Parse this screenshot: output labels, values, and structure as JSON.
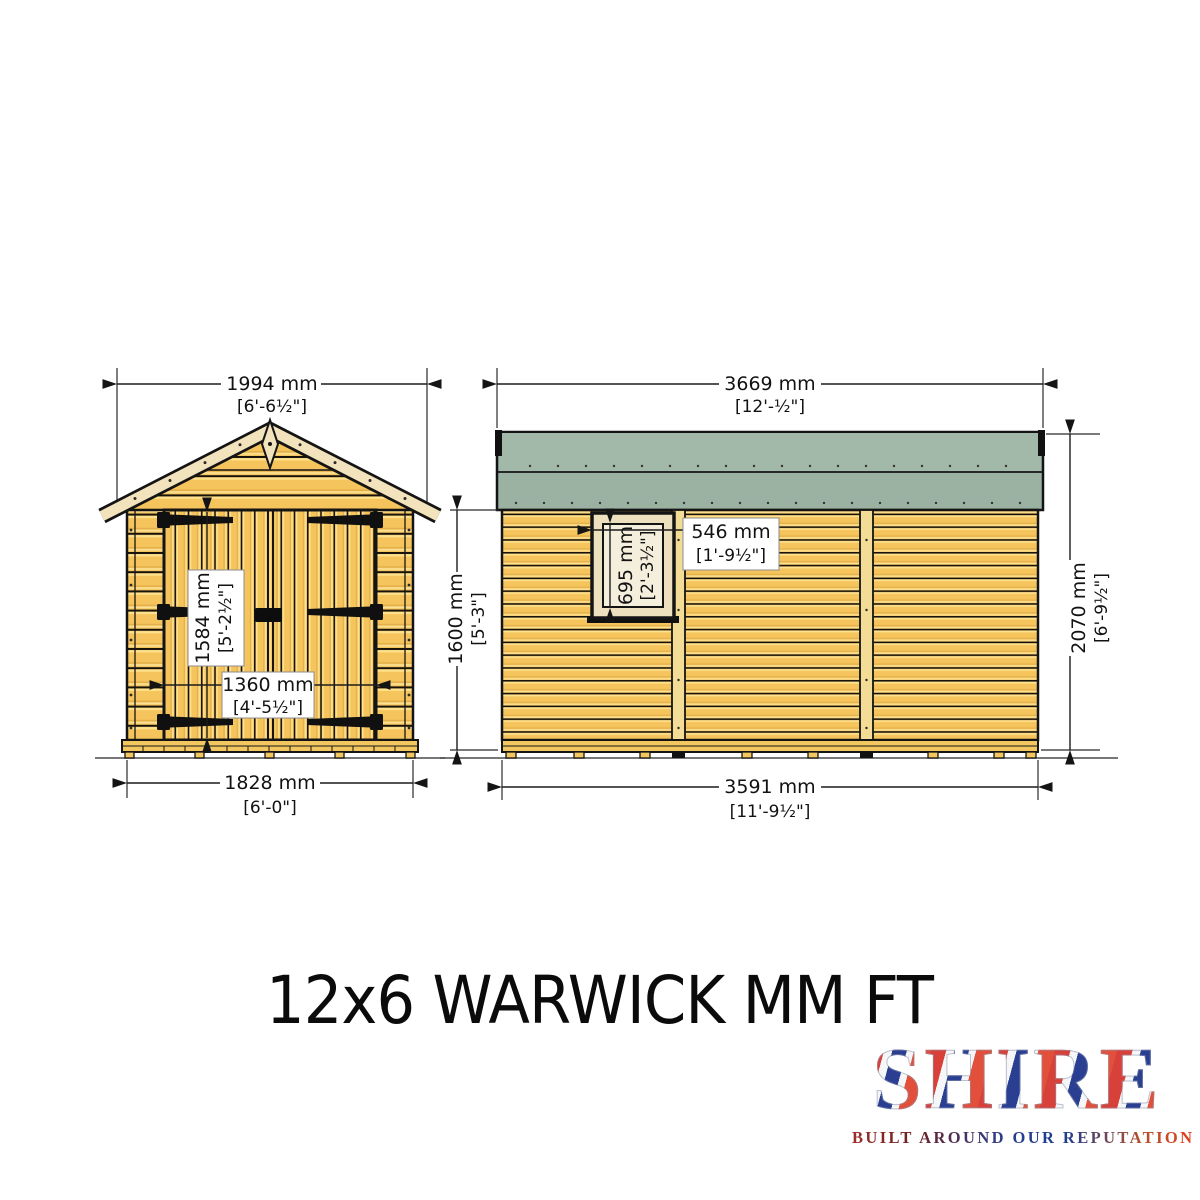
{
  "title": "12x6 WARWICK MM FT",
  "views": {
    "front": {
      "label": "front-elevation",
      "dims": {
        "width_top": {
          "mm": "1994 mm",
          "ft": "[6'-6½\"]"
        },
        "door_height": {
          "mm": "1584 mm",
          "ft": "[5'-2½\"]"
        },
        "door_width": {
          "mm": "1360 mm",
          "ft": "[4'-5½\"]"
        },
        "width_base": {
          "mm": "1828 mm",
          "ft": "[6'-0\"]"
        }
      }
    },
    "side": {
      "label": "side-elevation",
      "dims": {
        "length_top": {
          "mm": "3669 mm",
          "ft": "[12'-½\"]"
        },
        "window_width": {
          "mm": "546 mm",
          "ft": "[1'-9½\"]"
        },
        "window_height": {
          "mm": "695 mm",
          "ft": "[2'-3½\"]"
        },
        "height_eaves": {
          "mm": "1600 mm",
          "ft": "[5'-3\"]"
        },
        "height_ridge": {
          "mm": "2070 mm",
          "ft": "[6'-9½\"]"
        },
        "length_base": {
          "mm": "3591 mm",
          "ft": "[11'-9½\"]"
        }
      }
    }
  },
  "logo": {
    "brand": "SHIRE",
    "tagline": "BUILT AROUND OUR REPUTATION"
  },
  "colors": {
    "wood": "#F5C45C",
    "wood_highlight": "#FFE18C",
    "roof_green": "#9BB2A3",
    "fascia_cream": "#F2E3BD",
    "window_glass": "#F4EEDC",
    "outline": "#141414",
    "logo_red": "#D8403A",
    "logo_blue": "#2A3F92"
  }
}
